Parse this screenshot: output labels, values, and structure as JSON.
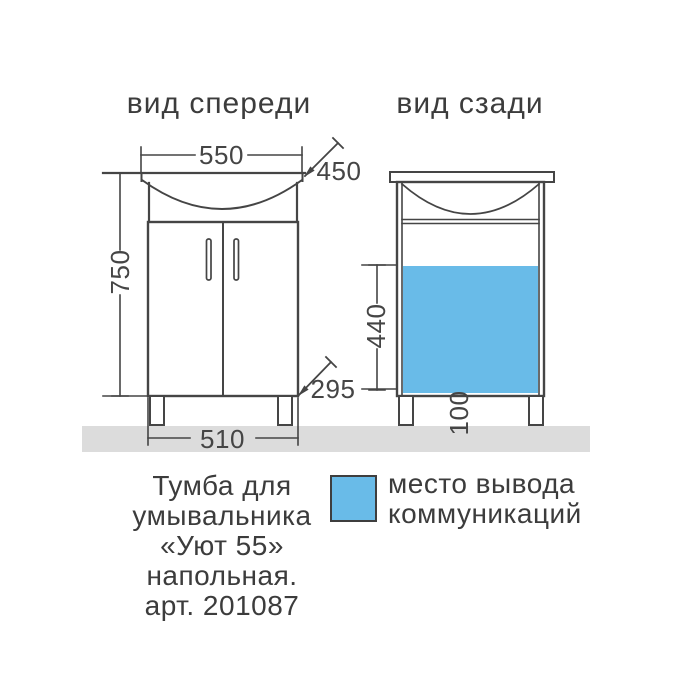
{
  "views": {
    "front": {
      "title": "вид спереди",
      "dims": {
        "sink_width": "550",
        "depth": "450",
        "height": "750",
        "corner_offset": "295",
        "cabinet_width": "510"
      }
    },
    "back": {
      "title": "вид сзади",
      "dims": {
        "communications_height": "440",
        "leg_height": "100"
      }
    }
  },
  "caption": {
    "lines": [
      "Тумба для",
      "умывальника",
      "«Уют 55»",
      "напольная.",
      "арт. 201087"
    ]
  },
  "legend": {
    "lines": [
      "место вывода",
      "коммуникаций"
    ]
  },
  "colors": {
    "line": "#454545",
    "text": "#3c3c3c",
    "highlight_blue": "#69bbe8",
    "floor_gray": "#dcdcdc",
    "background": "#ffffff"
  }
}
